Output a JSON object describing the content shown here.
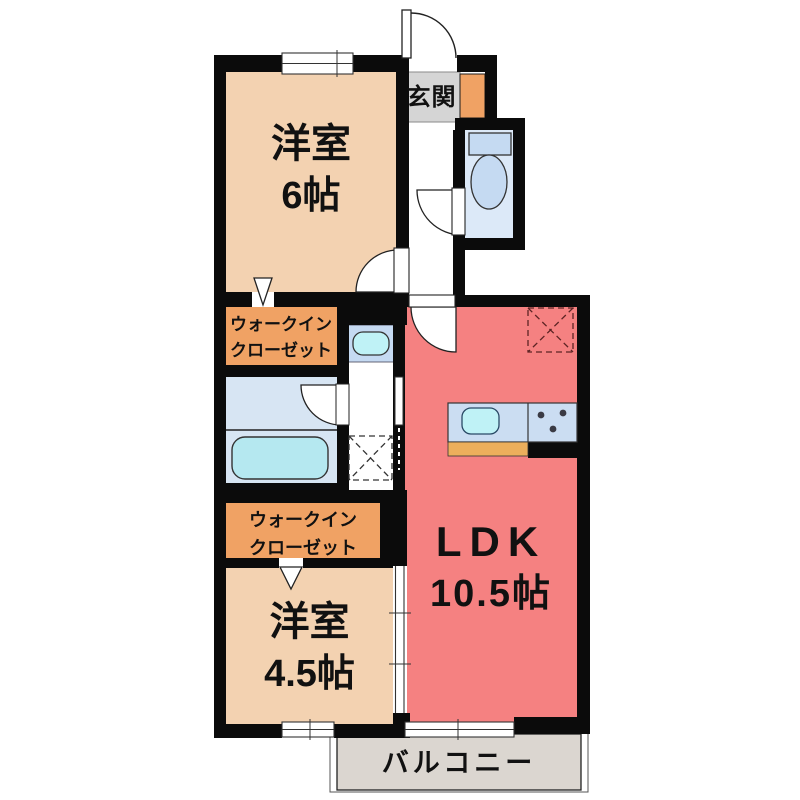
{
  "colors": {
    "wall": "#0b0b0b",
    "bedroom": "#f3d2b1",
    "closet": "#f0a264",
    "ldk": "#f58181",
    "wet_area": "#d7e5f3",
    "toilet_room": "#dce9f8",
    "tub": "#b5e8f0",
    "fixture_blue": "#c5daf2",
    "sink_cyan": "#bff2f6",
    "counter": "#cbddf2",
    "cabinet": "#edaf5c",
    "genkan": "#d5d5d5",
    "balcony": "#dbd6d0"
  },
  "rooms": {
    "entrance": {
      "label": "玄関"
    },
    "bedroom1": {
      "name": "洋室",
      "size": "6帖"
    },
    "walk_in_closet_1": {
      "line1": "ウォークイン",
      "line2": "クローゼット"
    },
    "walk_in_closet_2": {
      "line1": "ウォークイン",
      "line2": "クローゼット"
    },
    "ldk": {
      "name": "LDK",
      "size": "10.5帖"
    },
    "bedroom2": {
      "name": "洋室",
      "size": "4.5帖"
    },
    "balcony": {
      "label": "バルコニー"
    }
  },
  "fixtures": {
    "toilet": "toilet-icon",
    "bathtub": "bathtub-icon",
    "vanity": "vanity-sink-icon",
    "washing_machine_space": "washing-machine-space-icon",
    "refrigerator_space": "refrigerator-space-icon",
    "kitchen_sink": "kitchen-sink-icon",
    "stove": "stove-icon"
  }
}
